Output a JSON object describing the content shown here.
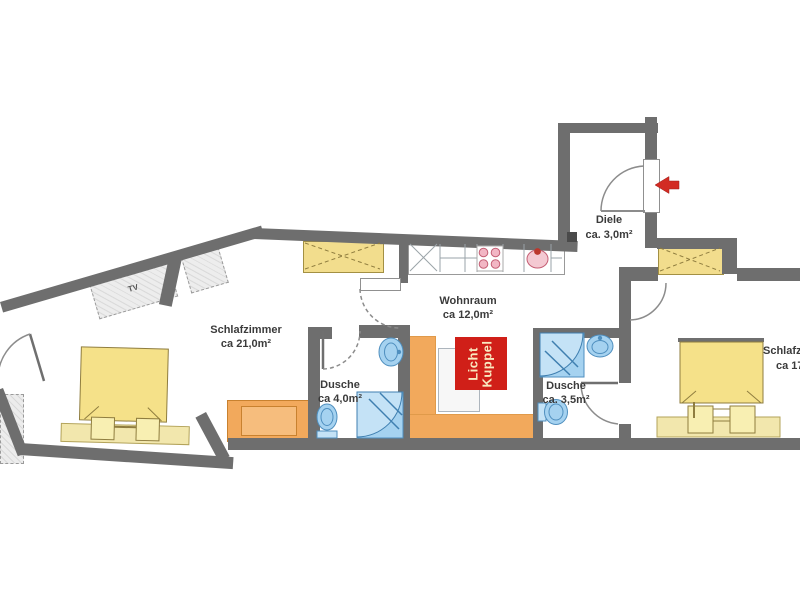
{
  "plan": {
    "rooms": {
      "schlafzimmer_links": {
        "name": "Schlafzimmer",
        "area": "ca 21,0m²"
      },
      "wohnraum": {
        "name": "Wohnraum",
        "area": "ca 12,0m²"
      },
      "dusche_links": {
        "name": "Dusche",
        "area": "ca 4,0m²"
      },
      "dusche_rechts": {
        "name": "Dusche",
        "area": "ca. 3,5m²"
      },
      "diele": {
        "name": "Diele",
        "area": "ca. 3,0m²"
      },
      "schlafzimmer_rechts": {
        "name": "Schlafzi",
        "area": "ca 17"
      }
    },
    "annotations": {
      "skylight_line1": "Licht",
      "skylight_line2": "Kuppel",
      "tv_label": "TV"
    },
    "colors": {
      "wall": "#6e6e6e",
      "wardrobe_yellow": "#f2dd8d",
      "bed_yellow": "#f5e189",
      "sofa_orange": "#f2a95c",
      "fixture_blue": "#a5d2f0",
      "accent_red": "#d01f18",
      "arrow_red": "#d22b23",
      "label_text": "#3b3b3b",
      "furniture_gray": "#ededed"
    }
  }
}
